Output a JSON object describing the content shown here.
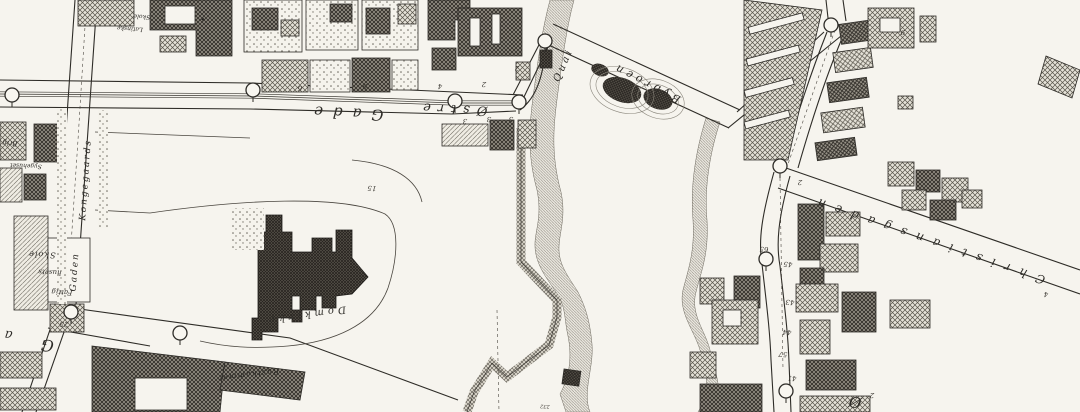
{
  "map": {
    "type": "historical-town-plan-scan",
    "colors": {
      "paper": "#f6f4ee",
      "ink": "#2d2b27",
      "hatch": "#57534a",
      "river": "#7d7970"
    },
    "labels": [
      {
        "id": "street-ostre-gade-word2",
        "text": "Gade",
        "x": 344,
        "y": 108,
        "r": 183,
        "s": 15,
        "sp": 10
      },
      {
        "id": "street-ostre-gade-word1",
        "text": "Østre",
        "x": 452,
        "y": 105,
        "r": 183,
        "s": 13,
        "sp": 7
      },
      {
        "id": "bridge-bybroen",
        "text": "Bybroen",
        "x": 648,
        "y": 80,
        "r": 207,
        "s": 11,
        "sp": 4
      },
      {
        "id": "quai",
        "text": "Quai",
        "x": 566,
        "y": 66,
        "r": 293,
        "s": 10,
        "sp": 3
      },
      {
        "id": "street-christiansgaden",
        "text": "Christiansgaden",
        "x": 928,
        "y": 236,
        "r": 199,
        "s": 12,
        "sp": 10
      },
      {
        "id": "street-kongegaards",
        "text": "Kongegaards",
        "x": 88,
        "y": 180,
        "r": 274,
        "s": 9,
        "sp": 2
      },
      {
        "id": "street-gaden",
        "text": "Gaden",
        "x": 77,
        "y": 272,
        "r": 274,
        "s": 9,
        "sp": 2
      },
      {
        "id": "cathedral-domkirke",
        "text": "Domkirke",
        "x": 305,
        "y": 312,
        "r": 172,
        "s": 10,
        "sp": 4
      },
      {
        "id": "rustkammer",
        "text": "Rustkammer",
        "x": 248,
        "y": 372,
        "r": 173,
        "s": 8,
        "sp": 1
      },
      {
        "id": "skole",
        "text": "Skole",
        "x": 42,
        "y": 252,
        "r": 183,
        "s": 8,
        "sp": 1
      },
      {
        "id": "skole-2",
        "text": "husets",
        "x": 50,
        "y": 270,
        "r": 183,
        "s": 7,
        "sp": 0
      },
      {
        "id": "skole-3",
        "text": "Fattig",
        "x": 62,
        "y": 290,
        "r": 183,
        "s": 7,
        "sp": 0
      },
      {
        "id": "latin-school-1",
        "text": "Skole",
        "x": 142,
        "y": 15,
        "r": 184,
        "s": 6,
        "sp": 0
      },
      {
        "id": "latin-school-2",
        "text": "Latinske",
        "x": 130,
        "y": 27,
        "r": 184,
        "s": 6,
        "sp": 0
      },
      {
        "id": "sygehuset",
        "text": "Sygehuset",
        "x": 26,
        "y": 164,
        "r": 183,
        "s": 6,
        "sp": 0
      },
      {
        "id": "edge-fragment",
        "text": "Brig",
        "x": 10,
        "y": 141,
        "r": 183,
        "s": 7,
        "sp": 0
      },
      {
        "id": "big-letter-G",
        "text": "G",
        "x": 48,
        "y": 340,
        "r": 187,
        "s": 16,
        "sp": 0
      },
      {
        "id": "big-letter-a",
        "text": "a",
        "x": 9,
        "y": 331,
        "r": 187,
        "s": 13,
        "sp": 0
      },
      {
        "id": "big-letter-O",
        "text": "Ø",
        "x": 856,
        "y": 397,
        "r": 190,
        "s": 15,
        "sp": 0
      }
    ],
    "numbers": [
      {
        "t": "9",
        "x": 365,
        "y": 84
      },
      {
        "t": "4",
        "x": 440,
        "y": 84
      },
      {
        "t": "2",
        "x": 484,
        "y": 82
      },
      {
        "t": "2",
        "x": 517,
        "y": 66
      },
      {
        "t": "3",
        "x": 465,
        "y": 119
      },
      {
        "t": "3",
        "x": 489,
        "y": 117
      },
      {
        "t": "3",
        "x": 511,
        "y": 117
      },
      {
        "t": "6",
        "x": 300,
        "y": 86
      },
      {
        "t": "15",
        "x": 372,
        "y": 186
      },
      {
        "t": "25",
        "x": 64,
        "y": 322
      },
      {
        "t": "65",
        "x": 764,
        "y": 247
      },
      {
        "t": "45",
        "x": 788,
        "y": 262
      },
      {
        "t": "43",
        "x": 790,
        "y": 300
      },
      {
        "t": "44",
        "x": 787,
        "y": 330
      },
      {
        "t": "57",
        "x": 783,
        "y": 352
      },
      {
        "t": "41",
        "x": 792,
        "y": 376
      },
      {
        "t": "9",
        "x": 903,
        "y": 30
      },
      {
        "t": "2",
        "x": 872,
        "y": 393
      },
      {
        "t": "232",
        "x": 545,
        "y": 405
      },
      {
        "t": "2",
        "x": 800,
        "y": 180
      },
      {
        "t": "4",
        "x": 1046,
        "y": 292
      }
    ],
    "wells": [
      {
        "x": 12,
        "y": 95
      },
      {
        "x": 253,
        "y": 90
      },
      {
        "x": 455,
        "y": 101
      },
      {
        "x": 519,
        "y": 102
      },
      {
        "x": 545,
        "y": 41
      },
      {
        "x": 831,
        "y": 25
      },
      {
        "x": 780,
        "y": 166
      },
      {
        "x": 766,
        "y": 259
      },
      {
        "x": 786,
        "y": 391
      },
      {
        "x": 71,
        "y": 312
      },
      {
        "x": 180,
        "y": 333
      }
    ]
  }
}
